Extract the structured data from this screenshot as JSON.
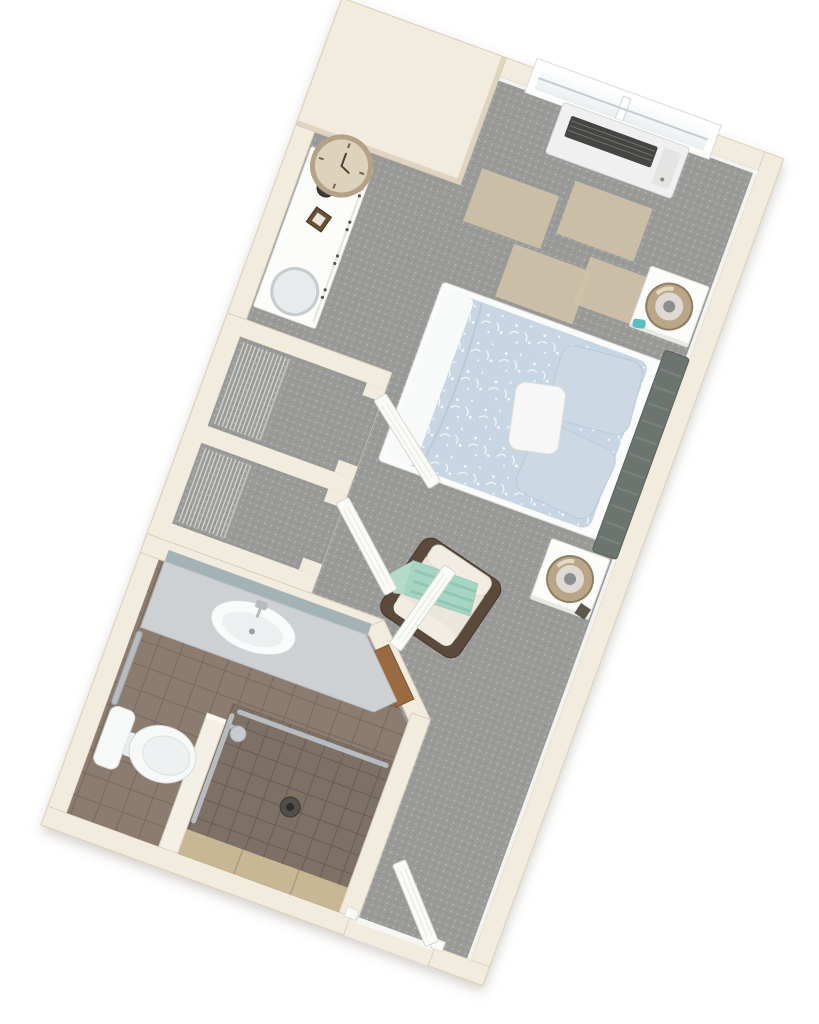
{
  "page": {
    "title": "3D floor plan rendering of a studio apartment",
    "type": "floor-plan",
    "rotation_deg": 20
  },
  "rooms": [
    {
      "id": "bedroom",
      "name": "Bedroom / living area",
      "floor": "gray carpet"
    },
    {
      "id": "closet-1",
      "name": "Closet 1",
      "floor": "gray carpet",
      "feature": "wire shelving, open door"
    },
    {
      "id": "closet-2",
      "name": "Closet 2",
      "floor": "gray carpet",
      "feature": "wire shelving, open door"
    },
    {
      "id": "bathroom",
      "name": "Bathroom",
      "floor": "tan tile",
      "feature": "angled doorway with wood threshold"
    },
    {
      "id": "shower",
      "name": "Walk-in shower",
      "floor": "dark tile",
      "feature": "grab bars, shower head, drain, bench"
    },
    {
      "id": "entry",
      "name": "Entry",
      "floor": "gray carpet",
      "feature": "open entry door"
    }
  ],
  "furniture": [
    "double-hung window (two sashes)",
    "PTAC heater/air-conditioner under window",
    "queen bed with light-blue floral duvet and pillows",
    "dark upholstered slat headboard on right wall",
    "white nightstand with drum lamp (x2)",
    "white dresser with round wall clock, vase, picture frame and round mirror",
    "four beige accent carpet tiles",
    "dark-wood armchair with cream cushions and mint striped throw",
    "bathroom vanity with oval sink, chrome faucet and wall mirror",
    "wall grab bar beside toilet",
    "white toilet",
    "half wall between toilet and shower",
    "white open doors: two closet doors, bathroom door, entry door"
  ],
  "colors": {
    "background": "#ffffff",
    "wall": "#f2ecdf",
    "wallEdge": "#dcd0bb",
    "baseboard": "#fcfcfa",
    "carpet": "#9a9a98",
    "rug": "#cfc2a8",
    "tileBath": "#8c7c70",
    "tileShower": "#7d7065",
    "bench": "#c8b795",
    "wood": "#9a6b42",
    "door": "#fafaf7",
    "glassDark": "#e9eff1",
    "ptacBody": "#eff0ef",
    "ptacGrille": "#454543",
    "duvet": "#c8d6e4",
    "bedWhite": "#fafbfb",
    "pillow": "#ccd8e4",
    "accentPillow": "#f6f7f6",
    "headboard": "#6b746f",
    "headboardSlat": "#7d8781",
    "furnitureWhite": "#fcfcfb",
    "lampRing": "#b9a686",
    "lampRingEdge": "#8f7d61",
    "lampInner": "#ded9d2",
    "lampBase": "#8b8d8f",
    "chairFrame": "#5b4a3c",
    "cushion": "#ebe6dc",
    "cushionLight": "#f1ede3",
    "throw": "#a8d5c3",
    "throwStripe": "#8cc6b2",
    "teal": "#58bfc0",
    "chrome": "#b6bcc0",
    "counter": "#cdd1d4",
    "mirror": "#9eb0b2",
    "toilet": "#f7f8f8",
    "clockFace": "#ddd2bc",
    "clockRim": "#b3a286",
    "vase": "#3f3c38",
    "frameWood": "#6b4f33",
    "shelfWire": "#d0d0ce",
    "drain": "#514d48",
    "halfWall": "#f5f0e6"
  }
}
